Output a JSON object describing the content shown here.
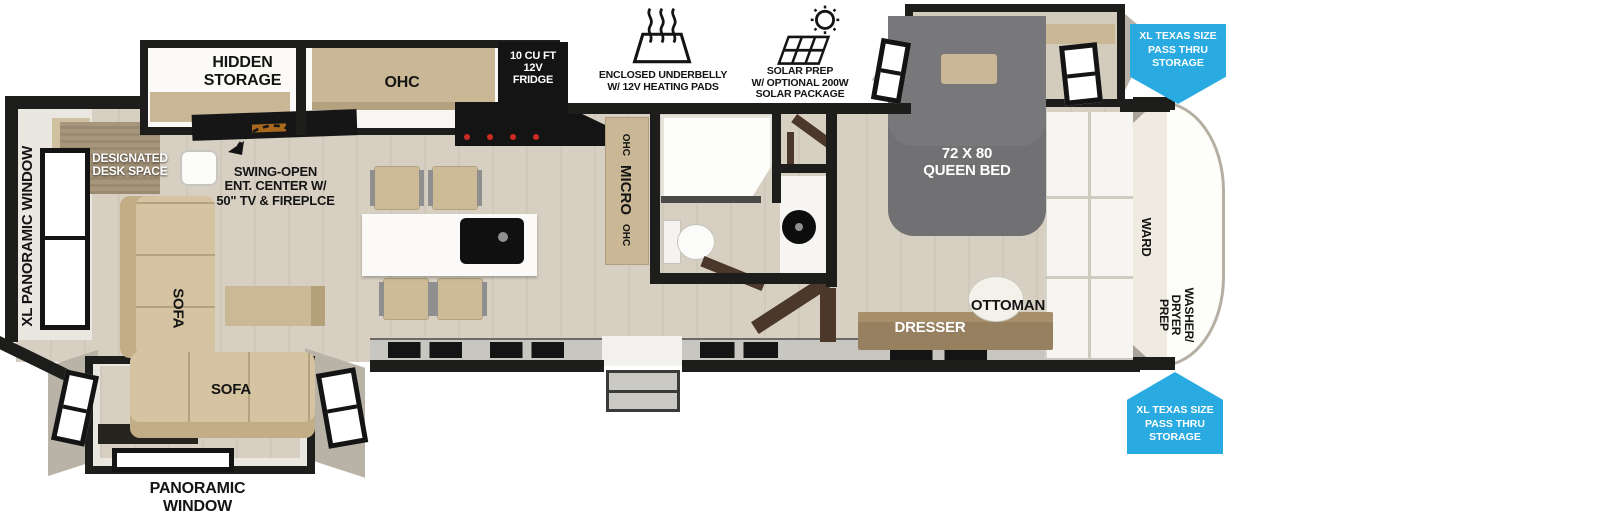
{
  "colors": {
    "wall": "#1d1d1b",
    "floor": "#d7d0c2",
    "wood": "#c9b795",
    "dark_wood": "#4b382a",
    "sofa": "#d5c3a1",
    "bed_gray": "#78787a",
    "arrow_blue": "#29abe2",
    "cap_trim": "#b5afa3"
  },
  "slideout_kitchen": {
    "hidden_storage": "HIDDEN\nSTORAGE",
    "ohc": "OHC",
    "fridge": "10 CU FT\n12V\nFRIDGE"
  },
  "callouts": {
    "underbelly": "ENCLOSED UNDERBELLY\nW/ 12V HEATING PADS",
    "solar": "SOLAR PREP\nW/ OPTIONAL 200W\nSOLAR PACKAGE",
    "pass_thru_top": "XL TEXAS SIZE\nPASS THRU\nSTORAGE",
    "pass_thru_bottom": "XL TEXAS SIZE\nPASS THRU\nSTORAGE",
    "ent_center": "SWING-OPEN\nENT. CENTER W/\n50\" TV & FIREPLCE"
  },
  "living": {
    "xl_window": "XL PANORAMIC WINDOW",
    "desk": "DESIGNATED\nDESK SPACE",
    "sofa_chaise": "SOFA",
    "sofa_main": "SOFA",
    "panoramic_window": "PANORAMIC\nWINDOW"
  },
  "kitchen": {
    "ohc_left": "OHC",
    "micro": "MICRO",
    "ohc_right": "OHC"
  },
  "bedroom": {
    "bed": "72 X 80\nQUEEN BED",
    "dresser": "DRESSER",
    "ottoman": "OTTOMAN",
    "ward": "WARD",
    "washer": "WASHER/\nDRYER\nPREP"
  }
}
